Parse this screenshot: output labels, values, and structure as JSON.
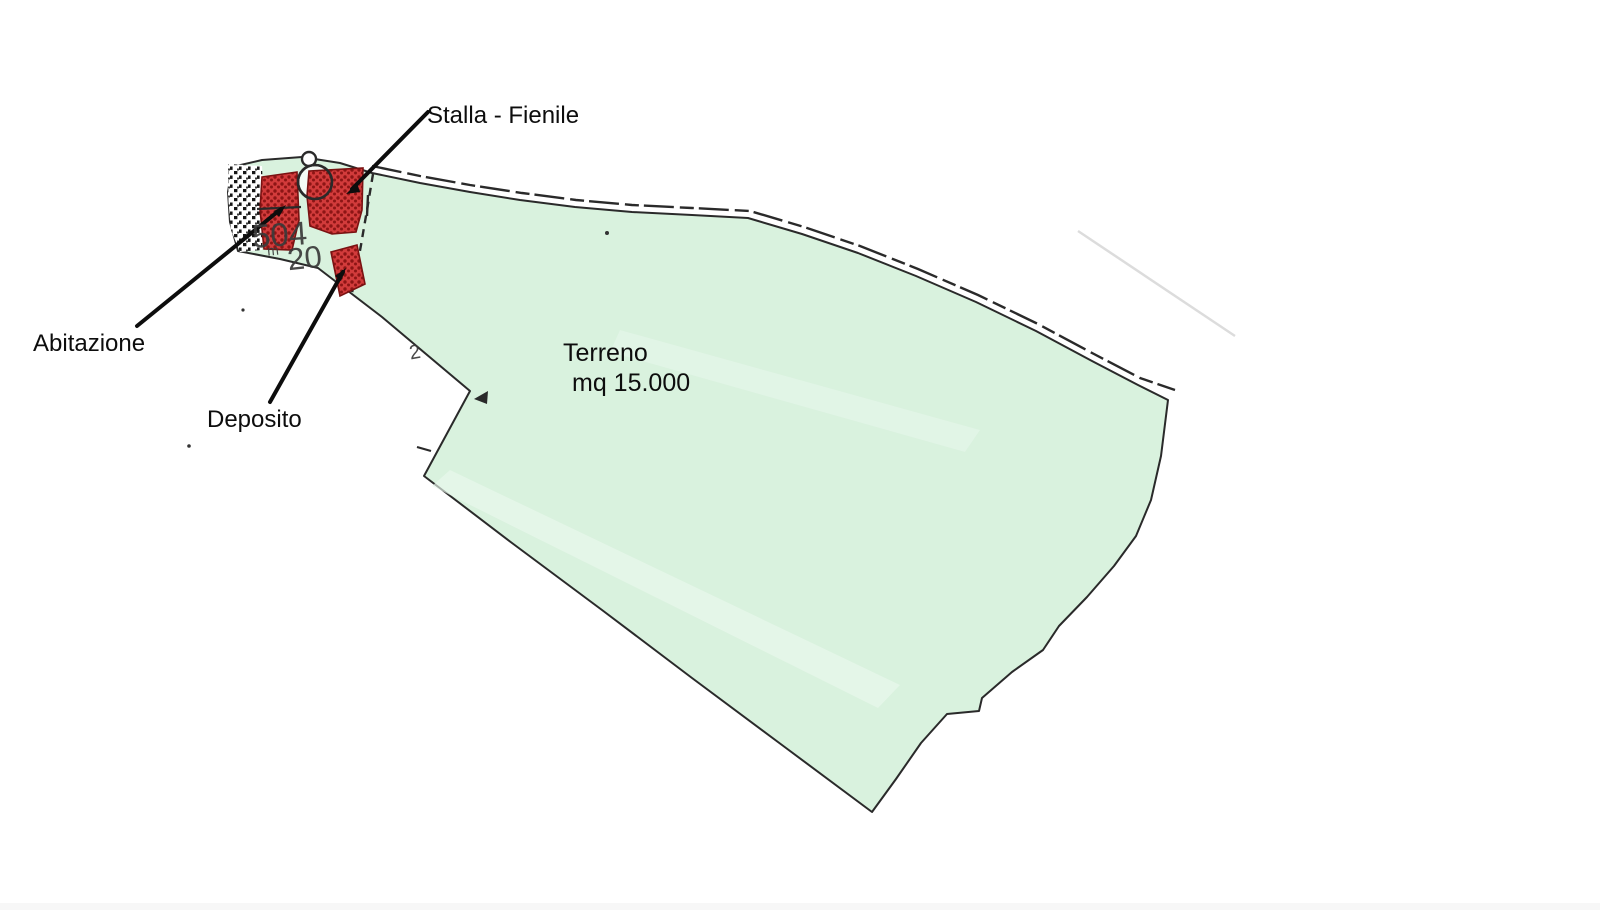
{
  "map": {
    "labels": {
      "stalla": "Stalla - Fienile",
      "abitazione": "Abitazione",
      "deposito": "Deposito",
      "terreno_line1": "Terreno",
      "terreno_line2": "mq 15.000"
    },
    "parcel_numbers": {
      "n504": "504",
      "n20": "20",
      "m_prefix": "m",
      "n2": "2"
    },
    "colors": {
      "land_fill": "#d9f2de",
      "land_streak": "#e9f8ed",
      "building_fill": "#d23b3b",
      "building_dot": "#8d1515",
      "building_stroke": "#7a1212",
      "outline": "#2a2a2a",
      "label_text": "#0d0d0d",
      "faint_line": "#d4d4d4"
    }
  }
}
